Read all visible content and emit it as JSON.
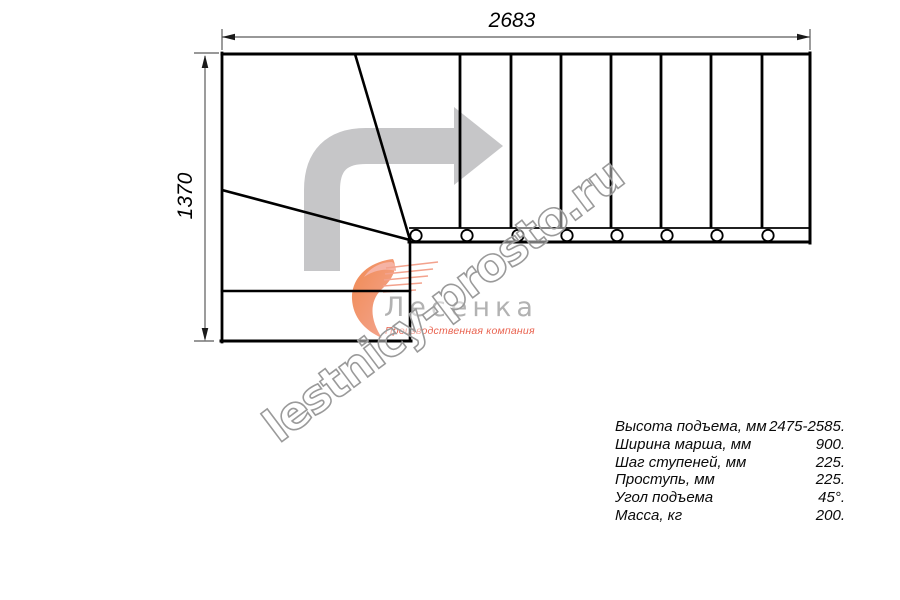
{
  "drawing": {
    "width_dim_label": "2683",
    "height_dim_label": "1370"
  },
  "watermark": {
    "text": "lestnicy-prosto.ru"
  },
  "logo": {
    "name": "Лесенка",
    "subtitle": "Производственная компания"
  },
  "specs": {
    "rows": [
      {
        "label": "Высота подъема, мм",
        "value": "2475-2585."
      },
      {
        "label": "Ширина марша, мм",
        "value": "900."
      },
      {
        "label": "Шаг ступеней, мм",
        "value": "225."
      },
      {
        "label": "Проступь, мм",
        "value": "225."
      },
      {
        "label": "Угол подъема",
        "value": "45°."
      },
      {
        "label": "Масса, кг",
        "value": "200."
      }
    ]
  },
  "colors": {
    "drawing_line": "#000000",
    "dimension_line": "#5a5a5a",
    "direction_arrow": "#c6c6c8",
    "watermark_outline": "#9a9a9a",
    "logo_text": "#b2b2b2",
    "logo_accent": "#e96350"
  }
}
